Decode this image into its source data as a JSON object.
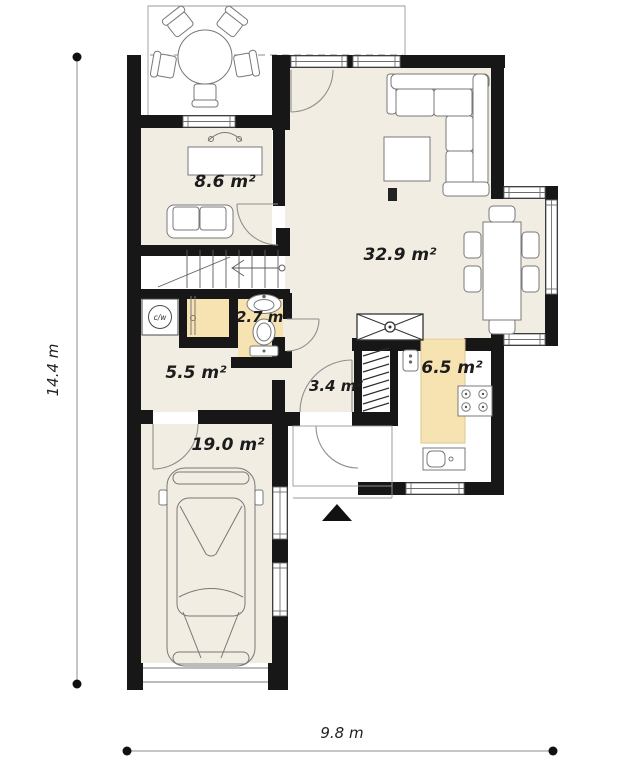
{
  "plan": {
    "type": "floor-plan",
    "rooms": [
      {
        "id": "study",
        "area": "8.6 m²"
      },
      {
        "id": "living-room",
        "area": "32.9 m²"
      },
      {
        "id": "bathroom",
        "area": "2.7 m²"
      },
      {
        "id": "hall",
        "area": "5.5 m²"
      },
      {
        "id": "corridor",
        "area": "3.4 m²"
      },
      {
        "id": "kitchen",
        "area": "6.5 m²"
      },
      {
        "id": "garage",
        "area": "19.0 m²"
      }
    ],
    "dimensions": {
      "vertical": "14.4 m",
      "horizontal": "9.8 m"
    },
    "equipment": {
      "boiler": "c/w"
    },
    "colors": {
      "walls": "#171717",
      "floor": "#f2ede3",
      "wet_zone": "#f7e3b1",
      "background": "#ffffff",
      "furniture_line": "#787878"
    }
  }
}
